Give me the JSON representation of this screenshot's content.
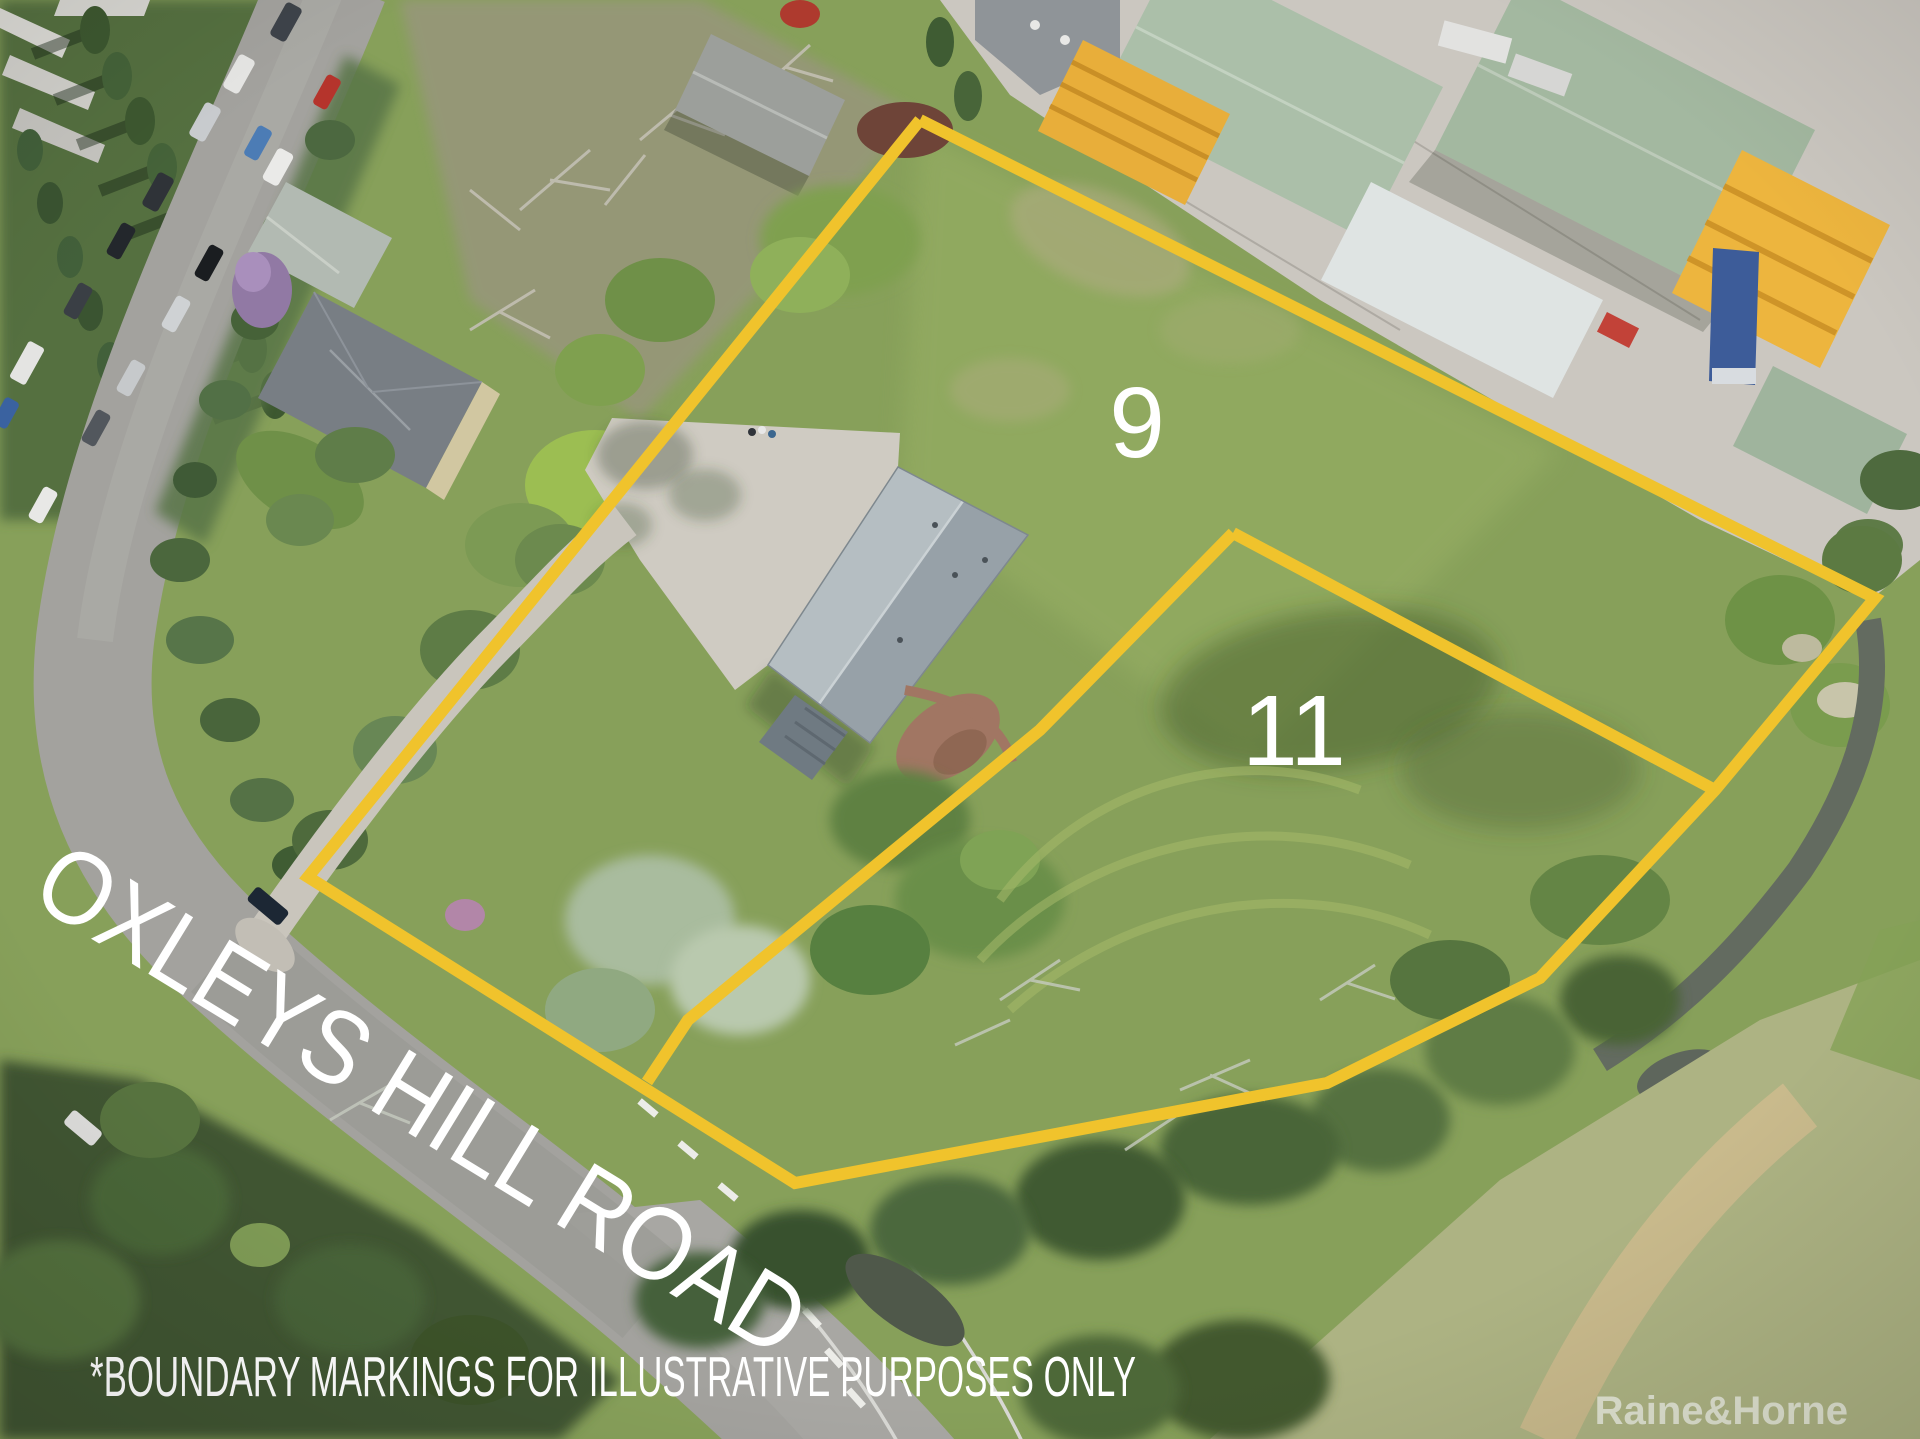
{
  "annotations": {
    "lot9_label": "9",
    "lot11_label": "11",
    "road_name": "OXLEYS HILL ROAD",
    "disclaimer": "*BOUNDARY MARKINGS FOR ILLUSTRATIVE PURPOSES ONLY",
    "watermark": "Raine&Horne"
  },
  "colors": {
    "boundary_line": "#F0C32C",
    "annotation_text": "#FFFFFF"
  },
  "boundaries": {
    "stroke_width": 12,
    "lot9_outline": "920,120 1875,598 1715,790 1540,978 1327,1083 795,1183 308,877 920,120",
    "lot11_top_edge": "1233,533 1715,790",
    "lot11_west_edge": "1233,533 1040,730 688,1020 647,1082"
  }
}
